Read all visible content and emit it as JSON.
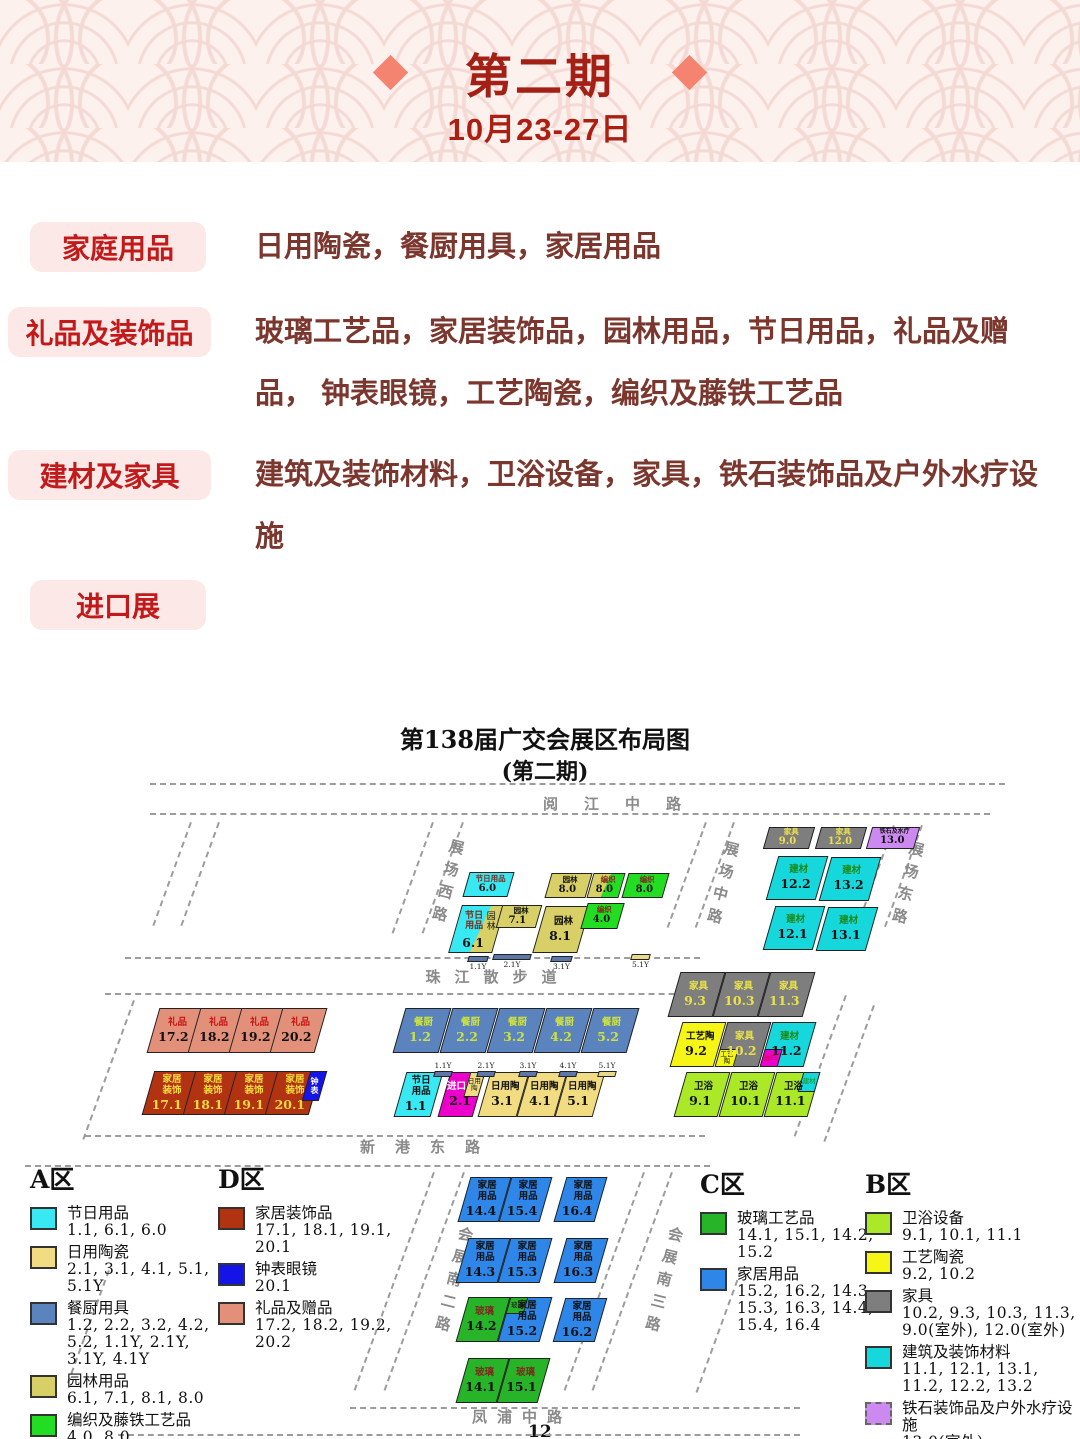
{
  "header": {
    "title": "第二期",
    "date": "10月23-27日"
  },
  "categories": [
    {
      "label": "家庭用品",
      "desc": "日用陶瓷，餐厨用具，家居用品"
    },
    {
      "label": "礼品及装饰品",
      "desc": "玻璃工艺品，家居装饰品，园林用品，节日用品，礼品及赠品， 钟表眼镜，工艺陶瓷，编织及藤铁工艺品"
    },
    {
      "label": "建材及家具",
      "desc": "建筑及装饰材料，卫浴设备，家具，铁石装饰品及户外水疗设施"
    },
    {
      "label": "进口展",
      "desc": ""
    }
  ],
  "map": {
    "title": "第138届广交会展区布局图",
    "subtitle": "(第二期)",
    "page": "12",
    "road_labels_h": [
      {
        "label": "阅江中路",
        "x": 625,
        "y": 83,
        "ls": 26
      },
      {
        "label": "珠江散步道",
        "x": 498,
        "y": 256,
        "ls": 14
      },
      {
        "label": "新港东路",
        "x": 430,
        "y": 426,
        "ls": 20
      },
      {
        "label": "凤浦中路",
        "x": 522,
        "y": 696,
        "ls": 10
      }
    ],
    "road_labels_v": [
      {
        "label": "展场西路",
        "x": 437,
        "y": 128
      },
      {
        "label": "展场中路",
        "x": 712,
        "y": 130
      },
      {
        "label": "展场东路",
        "x": 897,
        "y": 130
      },
      {
        "label": "会展南二路",
        "x": 443,
        "y": 515
      },
      {
        "label": "会展南三路",
        "x": 653,
        "y": 515
      }
    ],
    "blocks": [
      {
        "x": 766,
        "y": 117,
        "w": 46,
        "h": 22,
        "bg": "#7e7e7e",
        "label": "家具",
        "num": "9.0",
        "lc": "#eae24a",
        "nc": "#eae24a",
        "cls": "sm"
      },
      {
        "x": 818,
        "y": 117,
        "w": 46,
        "h": 22,
        "bg": "#7e7e7e",
        "label": "家具",
        "num": "12.0",
        "lc": "#eae24a",
        "nc": "#eae24a",
        "cls": "sm"
      },
      {
        "x": 869,
        "y": 117,
        "w": 48,
        "h": 22,
        "bg": "#cc8af0",
        "label": "铁石及水疗",
        "num": "13.0",
        "cls": "sm tiny"
      },
      {
        "x": 772,
        "y": 146,
        "w": 50,
        "h": 44,
        "bg": "#16d8dc",
        "label": "建材",
        "num": "12.2",
        "lc": "#1b8a1b"
      },
      {
        "x": 825,
        "y": 147,
        "w": 50,
        "h": 44,
        "bg": "#16d8dc",
        "label": "建材",
        "num": "13.2",
        "lc": "#1b8a1b"
      },
      {
        "x": 769,
        "y": 196,
        "w": 50,
        "h": 44,
        "bg": "#16d8dc",
        "label": "建材",
        "num": "12.1",
        "lc": "#1b8a1b"
      },
      {
        "x": 822,
        "y": 197,
        "w": 50,
        "h": 44,
        "bg": "#16d8dc",
        "label": "建材",
        "num": "13.1",
        "lc": "#1b8a1b"
      },
      {
        "x": 466,
        "y": 162,
        "w": 45,
        "h": 25,
        "bg": "#38e8f2",
        "label": "节日用品",
        "num": "6.0",
        "lc": "#7b2d1e",
        "cls": "sm"
      },
      {
        "x": 548,
        "y": 163,
        "w": 41,
        "h": 25,
        "bg": "#d8d066",
        "label": "园林",
        "num": "8.0",
        "cls": "sm"
      },
      {
        "x": 590,
        "y": 163,
        "w": 32,
        "h": 25,
        "bg": "#d8d066",
        "bg2": "#22dd22",
        "split": 50,
        "label": "编织",
        "num": "8.0",
        "lc": "#7b2d1e",
        "cls": "sm"
      },
      {
        "x": 625,
        "y": 163,
        "w": 41,
        "h": 25,
        "bg": "#22dd22",
        "label": "编织",
        "num": "8.0",
        "lc": "#7b2d1e",
        "cls": "sm"
      },
      {
        "x": 455,
        "y": 195,
        "w": 44,
        "h": 48,
        "bg": "#38e8f2",
        "bg2": "#d8d066",
        "split": 57,
        "label": "节日用品",
        "label2": "园林",
        "num": "6.1",
        "lc": "#7b2d1e",
        "cls": "b61"
      },
      {
        "x": 499,
        "y": 195,
        "w": 40,
        "h": 23,
        "bg": "#d8d066",
        "label": "园林",
        "num": "7.1",
        "cls": "sm"
      },
      {
        "x": 539,
        "y": 196,
        "w": 45,
        "h": 47,
        "bg": "#d8d066",
        "label": "园林",
        "num": "8.1"
      },
      {
        "x": 584,
        "y": 193,
        "w": 37,
        "h": 26,
        "bg": "#22dd22",
        "label": "编织",
        "num": "4.0",
        "lc": "#7b2d1e",
        "cls": "sm"
      },
      {
        "x": 153,
        "y": 298,
        "w": 45,
        "h": 45,
        "bg": "#e2907a",
        "label": "礼品",
        "num": "17.2",
        "lc": "#cc1515"
      },
      {
        "x": 194,
        "y": 298,
        "w": 45,
        "h": 45,
        "bg": "#e2907a",
        "label": "礼品",
        "num": "18.2",
        "lc": "#cc1515"
      },
      {
        "x": 235,
        "y": 298,
        "w": 45,
        "h": 45,
        "bg": "#e2907a",
        "label": "礼品",
        "num": "19.2",
        "lc": "#cc1515"
      },
      {
        "x": 276,
        "y": 298,
        "w": 45,
        "h": 45,
        "bg": "#e2907a",
        "label": "礼品",
        "num": "20.2",
        "lc": "#cc1515"
      },
      {
        "x": 148,
        "y": 361,
        "w": 44,
        "h": 44,
        "bg": "#b23312",
        "label": "家居装饰",
        "num": "17.1",
        "lc": "#f2dc3c",
        "nc": "#f2dc3c",
        "cls": "nar"
      },
      {
        "x": 189,
        "y": 361,
        "w": 44,
        "h": 44,
        "bg": "#b23312",
        "label": "家居装饰",
        "num": "18.1",
        "lc": "#f2dc3c",
        "nc": "#f2dc3c",
        "cls": "nar"
      },
      {
        "x": 230,
        "y": 361,
        "w": 44,
        "h": 44,
        "bg": "#b23312",
        "label": "家居装饰",
        "num": "19.1",
        "lc": "#f2dc3c",
        "nc": "#f2dc3c",
        "cls": "nar"
      },
      {
        "x": 271,
        "y": 361,
        "w": 44,
        "h": 44,
        "bg": "#b23312",
        "label": "家居装饰",
        "num": "20.1",
        "lc": "#f2dc3c",
        "nc": "#f2dc3c",
        "cls": "nar"
      },
      {
        "x": 306,
        "y": 361,
        "w": 17,
        "h": 30,
        "bg": "#1414e6",
        "label": "钟表",
        "lc": "#ffffff",
        "cls": "clock"
      },
      {
        "x": 399,
        "y": 298,
        "w": 46,
        "h": 45,
        "bg": "#5b84be",
        "label": "餐厨",
        "num": "1.2",
        "lc": "#cde23e",
        "nc": "#cde23e"
      },
      {
        "x": 446,
        "y": 298,
        "w": 46,
        "h": 45,
        "bg": "#5b84be",
        "label": "餐厨",
        "num": "2.2",
        "lc": "#cde23e",
        "nc": "#cde23e"
      },
      {
        "x": 493,
        "y": 298,
        "w": 46,
        "h": 45,
        "bg": "#5b84be",
        "label": "餐厨",
        "num": "3.2",
        "lc": "#cde23e",
        "nc": "#cde23e"
      },
      {
        "x": 540,
        "y": 298,
        "w": 46,
        "h": 45,
        "bg": "#5b84be",
        "label": "餐厨",
        "num": "4.2",
        "lc": "#cde23e",
        "nc": "#cde23e"
      },
      {
        "x": 587,
        "y": 298,
        "w": 46,
        "h": 45,
        "bg": "#5b84be",
        "label": "餐厨",
        "num": "5.2",
        "lc": "#cde23e",
        "nc": "#cde23e"
      },
      {
        "x": 400,
        "y": 362,
        "w": 37,
        "h": 45,
        "bg": "#38e8f2",
        "label": "节日用品",
        "num": "1.1",
        "cls": "nar"
      },
      {
        "x": 444,
        "y": 362,
        "w": 35,
        "h": 45,
        "bg": "#ee00cc",
        "label": "进口",
        "num": "2.1",
        "lc": "#ffffff",
        "cls": "b21",
        "corner": {
          "pos": "tr",
          "w": "46%",
          "h": "58%",
          "bg": "#f2dc82",
          "text": "日用陶",
          "tc": "#111111"
        }
      },
      {
        "x": 484,
        "y": 362,
        "w": 39,
        "h": 45,
        "bg": "#f2dc82",
        "label": "日用陶",
        "num": "3.1"
      },
      {
        "x": 523,
        "y": 362,
        "w": 38,
        "h": 45,
        "bg": "#f2dc82",
        "label": "日用陶",
        "num": "4.1"
      },
      {
        "x": 561,
        "y": 362,
        "w": 38,
        "h": 45,
        "bg": "#f2dc82",
        "label": "日用陶",
        "num": "5.1"
      },
      {
        "x": 674,
        "y": 262,
        "w": 45,
        "h": 45,
        "bg": "#7e7e7e",
        "label": "家具",
        "num": "9.3",
        "lc": "#eae24a",
        "nc": "#eae24a"
      },
      {
        "x": 719,
        "y": 262,
        "w": 45,
        "h": 45,
        "bg": "#7e7e7e",
        "label": "家具",
        "num": "10.3",
        "lc": "#eae24a",
        "nc": "#eae24a"
      },
      {
        "x": 764,
        "y": 262,
        "w": 45,
        "h": 45,
        "bg": "#7e7e7e",
        "label": "家具",
        "num": "11.3",
        "lc": "#eae24a",
        "nc": "#eae24a"
      },
      {
        "x": 676,
        "y": 312,
        "w": 44,
        "h": 45,
        "bg": "#f6f616",
        "label": "工艺陶",
        "num": "9.2"
      },
      {
        "x": 721,
        "y": 312,
        "w": 44,
        "h": 45,
        "bg": "#7e7e7e",
        "label": "家具",
        "num": "10.2",
        "lc": "#eae24a",
        "nc": "#eae24a",
        "corner": {
          "pos": "bl",
          "w": "46%",
          "h": "42%",
          "bg": "#f6f616",
          "text": "工艺陶",
          "tc": "#111111"
        }
      },
      {
        "x": 766,
        "y": 312,
        "w": 44,
        "h": 45,
        "bg": "#16d8dc",
        "label": "建材",
        "num": "11.2",
        "lc": "#1b8a1b",
        "corner": {
          "pos": "bl",
          "w": "42%",
          "h": "42%",
          "bg": "#ee00cc",
          "text": "进口",
          "tc": "#cc0000"
        }
      },
      {
        "x": 680,
        "y": 362,
        "w": 44,
        "h": 45,
        "bg": "#aae828",
        "label": "卫浴",
        "num": "9.1"
      },
      {
        "x": 725,
        "y": 362,
        "w": 44,
        "h": 45,
        "bg": "#aae828",
        "label": "卫浴",
        "num": "10.1"
      },
      {
        "x": 770,
        "y": 362,
        "w": 44,
        "h": 45,
        "bg": "#aae828",
        "label": "卫浴",
        "num": "11.1",
        "corner": {
          "pos": "tr",
          "w": "40%",
          "h": "46%",
          "bg": "#16d8dc",
          "text": "建材",
          "tc": "#1b8a1b"
        }
      },
      {
        "x": 464,
        "y": 467,
        "w": 41,
        "h": 45,
        "bg": "#2e86e8",
        "label": "家居用品",
        "num": "14.4",
        "cls": "nar"
      },
      {
        "x": 505,
        "y": 467,
        "w": 41,
        "h": 45,
        "bg": "#2e86e8",
        "label": "家居用品",
        "num": "15.4",
        "cls": "nar"
      },
      {
        "x": 560,
        "y": 467,
        "w": 41,
        "h": 45,
        "bg": "#2e86e8",
        "label": "家居用品",
        "num": "16.4",
        "cls": "nar"
      },
      {
        "x": 462,
        "y": 528,
        "w": 42,
        "h": 45,
        "bg": "#2e86e8",
        "label": "家居用品",
        "num": "14.3",
        "cls": "nar"
      },
      {
        "x": 504,
        "y": 528,
        "w": 42,
        "h": 45,
        "bg": "#2e86e8",
        "label": "家居用品",
        "num": "15.3",
        "cls": "nar"
      },
      {
        "x": 560,
        "y": 528,
        "w": 42,
        "h": 45,
        "bg": "#2e86e8",
        "label": "家居用品",
        "num": "16.3",
        "cls": "nar"
      },
      {
        "x": 462,
        "y": 587,
        "w": 42,
        "h": 45,
        "bg": "#28b428",
        "label": "玻璃",
        "num": "14.2",
        "lc": "#7b2d1e"
      },
      {
        "x": 504,
        "y": 587,
        "w": 42,
        "h": 45,
        "bg": "#2e86e8",
        "label": "家居用品",
        "num": "15.2",
        "cls": "nar",
        "corner": {
          "pos": "tl",
          "w": "45%",
          "h": "40%",
          "bg": "#28b428",
          "text": "玻璃",
          "tc": "#111111"
        }
      },
      {
        "x": 559,
        "y": 588,
        "w": 42,
        "h": 44,
        "bg": "#2e86e8",
        "label": "家居用品",
        "num": "16.2",
        "cls": "nar"
      },
      {
        "x": 462,
        "y": 648,
        "w": 41,
        "h": 45,
        "bg": "#28b428",
        "label": "玻璃",
        "num": "14.1",
        "lc": "#7b2d1e"
      },
      {
        "x": 503,
        "y": 648,
        "w": 41,
        "h": 45,
        "bg": "#28b428",
        "label": "玻璃",
        "num": "15.1",
        "lc": "#7b2d1e"
      }
    ],
    "bars": [
      {
        "x": 461,
        "y": 246,
        "w": 20,
        "t": "slate",
        "label": "1.1Y",
        "lp": "b"
      },
      {
        "x": 486,
        "y": 244,
        "w": 38,
        "t": "slate",
        "label": "2.1Y",
        "lp": "b"
      },
      {
        "x": 544,
        "y": 246,
        "w": 21,
        "t": "slate",
        "label": "3.1Y",
        "lp": "b"
      },
      {
        "x": 624,
        "y": 244,
        "w": 19,
        "t": "khaki",
        "label": "5.1Y",
        "lp": "b"
      },
      {
        "x": 427,
        "y": 352,
        "w": 18,
        "t": "slate",
        "label": "1.1Y",
        "lp": "t"
      },
      {
        "x": 470,
        "y": 352,
        "w": 18,
        "t": "slate",
        "label": "2.1Y",
        "lp": "t"
      },
      {
        "x": 512,
        "y": 352,
        "w": 18,
        "t": "slate",
        "label": "3.1Y",
        "lp": "t"
      },
      {
        "x": 552,
        "y": 352,
        "w": 18,
        "t": "slate",
        "label": "4.1Y",
        "lp": "t"
      },
      {
        "x": 591,
        "y": 352,
        "w": 18,
        "t": "khaki",
        "label": "5.1Y",
        "lp": "t"
      }
    ],
    "legends": [
      {
        "title": "A区",
        "x": 30,
        "y": 450,
        "w": 205,
        "items": [
          {
            "color": "#38e8f2",
            "label": "节日用品",
            "halls": "1.1, 6.1, 6.0"
          },
          {
            "color": "#f2dc82",
            "label": "日用陶瓷",
            "halls": "2.1, 3.1, 4.1, 5.1, 5.1Y"
          },
          {
            "color": "#5b84be",
            "label": "餐厨用具",
            "halls": "1.2, 2.2, 3.2, 4.2, 5.2, 1.1Y, 2.1Y, 3.1Y, 4.1Y"
          },
          {
            "color": "#d8d066",
            "label": "园林用品",
            "halls": "6.1, 7.1, 8.1, 8.0"
          },
          {
            "color": "#22dd22",
            "label": "编织及藤铁工艺品",
            "halls": "4.0, 8.0"
          },
          {
            "color": "#ee00cc",
            "label": "进口展",
            "halls": "2.1"
          }
        ]
      },
      {
        "title": "D区",
        "x": 218,
        "y": 450,
        "w": 215,
        "items": [
          {
            "color": "#b23312",
            "label": "家居装饰品",
            "halls": "17.1, 18.1, 19.1, 20.1"
          },
          {
            "color": "#1414e6",
            "label": "钟表眼镜",
            "halls": "20.1"
          },
          {
            "color": "#e2907a",
            "label": "礼品及赠品",
            "halls": "17.2, 18.2, 19.2, 20.2"
          }
        ]
      },
      {
        "title": "C区",
        "x": 700,
        "y": 455,
        "w": 185,
        "items": [
          {
            "color": "#28b428",
            "label": "玻璃工艺品",
            "halls": "14.1, 15.1, 14.2, 15.2"
          },
          {
            "color": "#2e86e8",
            "label": "家居用品",
            "halls": "15.2, 16.2, 14.3, 15.3, 16.3, 14.4, 15.4, 16.4"
          }
        ]
      },
      {
        "title": "B区",
        "x": 865,
        "y": 455,
        "w": 215,
        "items": [
          {
            "color": "#aae828",
            "label": "卫浴设备",
            "halls": "9.1, 10.1, 11.1"
          },
          {
            "color": "#f6f616",
            "label": "工艺陶瓷",
            "halls": "9.2, 10.2"
          },
          {
            "color": "#7e7e7e",
            "label": "家具",
            "halls": "10.2, 9.3, 10.3, 11.3, 9.0(室外), 12.0(室外)"
          },
          {
            "color": "#16d8dc",
            "label": "建筑及装饰材料",
            "halls": "11.1, 12.1, 13.1, 11.2, 12.2, 13.2"
          },
          {
            "color": "#cc8af0",
            "dashed": true,
            "label": "铁石装饰品及户外水疗设施",
            "halls": "13.0(室外)"
          },
          {
            "color": "#ee00cc",
            "label": "进口展",
            "halls": "11.2"
          }
        ]
      }
    ]
  }
}
